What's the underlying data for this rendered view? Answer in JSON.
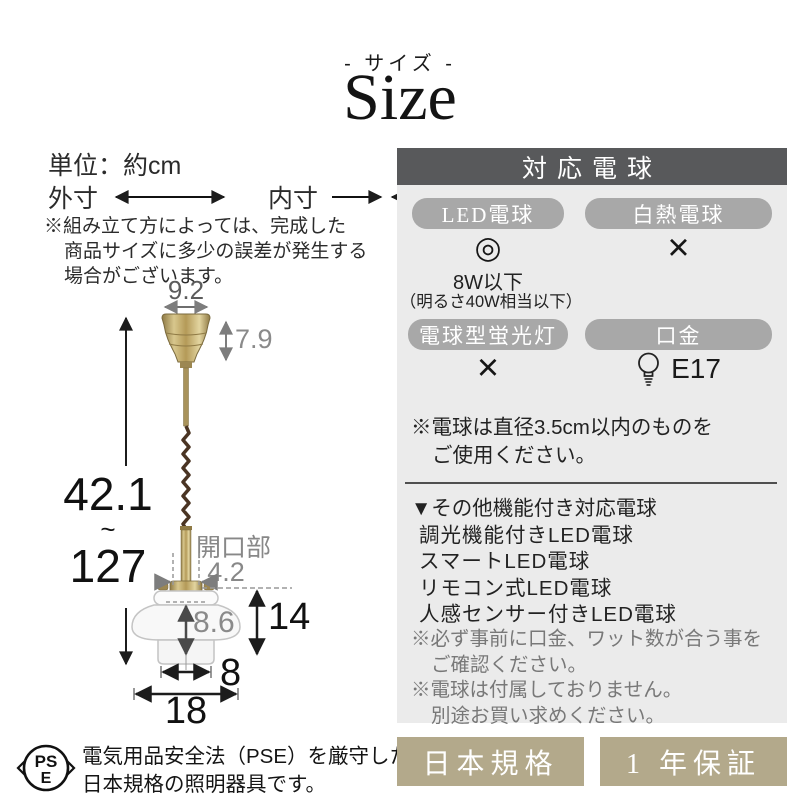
{
  "header": {
    "subtitle": "- サイズ -",
    "title": "Size"
  },
  "sizeinfo": {
    "unit": "単位：約cm",
    "outer": "外寸",
    "inner": "内寸",
    "note1": "※組み立て方によっては、完成した",
    "note2": "商品サイズに多少の誤差が発生する",
    "note3": "場合がございます。"
  },
  "diagram": {
    "cap_width": "9.2",
    "cap_height": "7.9",
    "height_min": "42.1",
    "height_tilde": "~",
    "height_max": "127",
    "opening_label": "開口部",
    "opening_width": "4.2",
    "shade_height": "14",
    "shade_inner_height": "8.6",
    "shade_inner_width": "8",
    "shade_outer_width": "18"
  },
  "bulb_panel": {
    "title": "対応電球",
    "led": {
      "label": "LED電球",
      "rating": "◎",
      "wattage": "8W以下",
      "wattage_note": "（明るさ40W相当以下）"
    },
    "incandescent": {
      "label": "白熱電球",
      "rating": "×"
    },
    "cfl": {
      "label": "電球型蛍光灯",
      "rating": "×"
    },
    "socket": {
      "label": "口金",
      "value": "E17",
      "icon": "bulb-icon"
    },
    "size_note1": "※電球は直径3.5cm以内のものを",
    "size_note2": "ご使用ください。",
    "other_title": "▼その他機能付き対応電球",
    "other_items": [
      "調光機能付きLED電球",
      "スマートLED電球",
      "リモコン式LED電球",
      "人感センサー付きLED電球"
    ],
    "caution1a": "※必ず事前に口金、ワット数が合う事を",
    "caution1b": "ご確認ください。",
    "caution2a": "※電球は付属しておりません。",
    "caution2b": "別途お買い求めください。"
  },
  "footer": {
    "pse_top": "PS",
    "pse_bottom": "E",
    "pse_text1": "電気用品安全法（PSE）を厳守した",
    "pse_text2": "日本規格の照明器具です。",
    "badge_standard": "日本規格",
    "badge_warranty": "1 年保証"
  },
  "colors": {
    "panel_header_bg": "#58595b",
    "pill_bg": "#a8a8a8",
    "panel_bg": "#ebebeb",
    "badge_bg": "#b3a98b",
    "brass": "#b49a58",
    "cord_brown": "#4a3423"
  }
}
